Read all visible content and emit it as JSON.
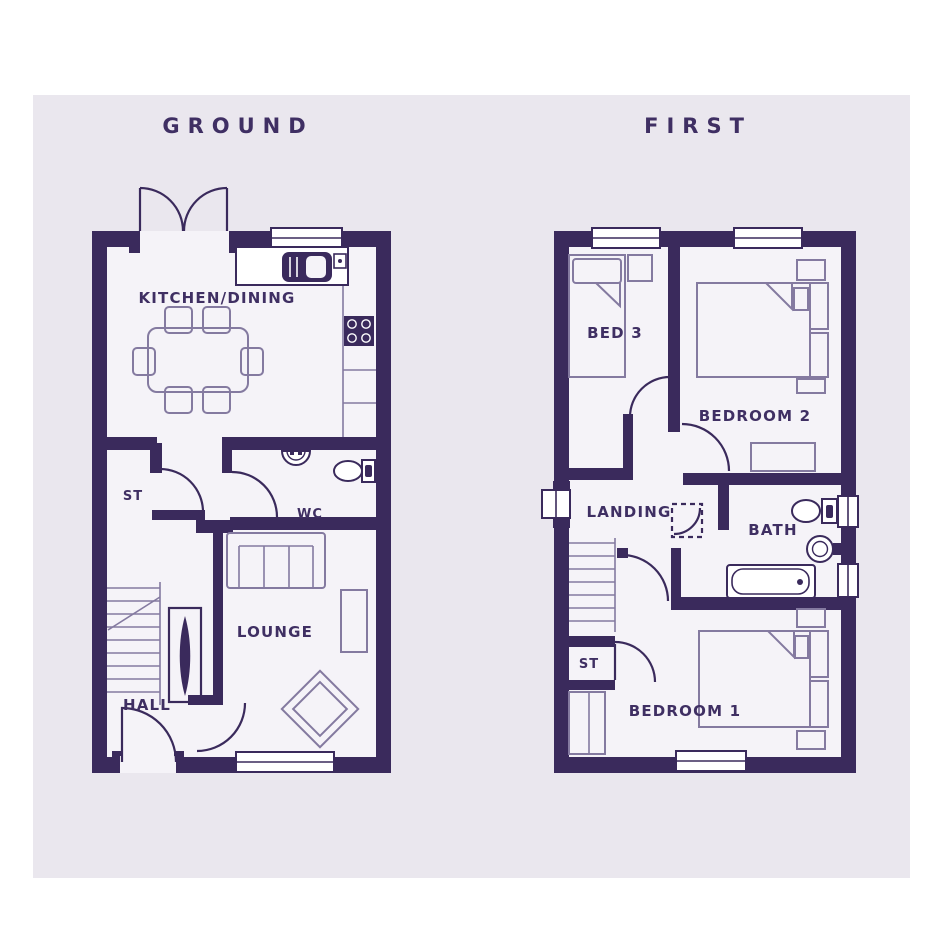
{
  "page": {
    "background": "#ffffff",
    "panel_background": "#eae7ee",
    "floor_color": "#f5f3f8",
    "wall_color": "#3a2a5c",
    "furniture_line_color": "#847aa0",
    "text_color": "#3f2f63"
  },
  "ground_floor": {
    "title": "GROUND",
    "labels": {
      "kitchen_dining": "KITCHEN/DINING",
      "storage": "ST",
      "wc": "WC",
      "lounge": "LOUNGE",
      "hall": "HALL"
    }
  },
  "first_floor": {
    "title": "FIRST",
    "labels": {
      "bed3": "BED 3",
      "bedroom2": "BEDROOM 2",
      "landing": "LANDING",
      "bath": "BATH",
      "storage": "ST",
      "bedroom1": "BEDROOM 1"
    }
  }
}
